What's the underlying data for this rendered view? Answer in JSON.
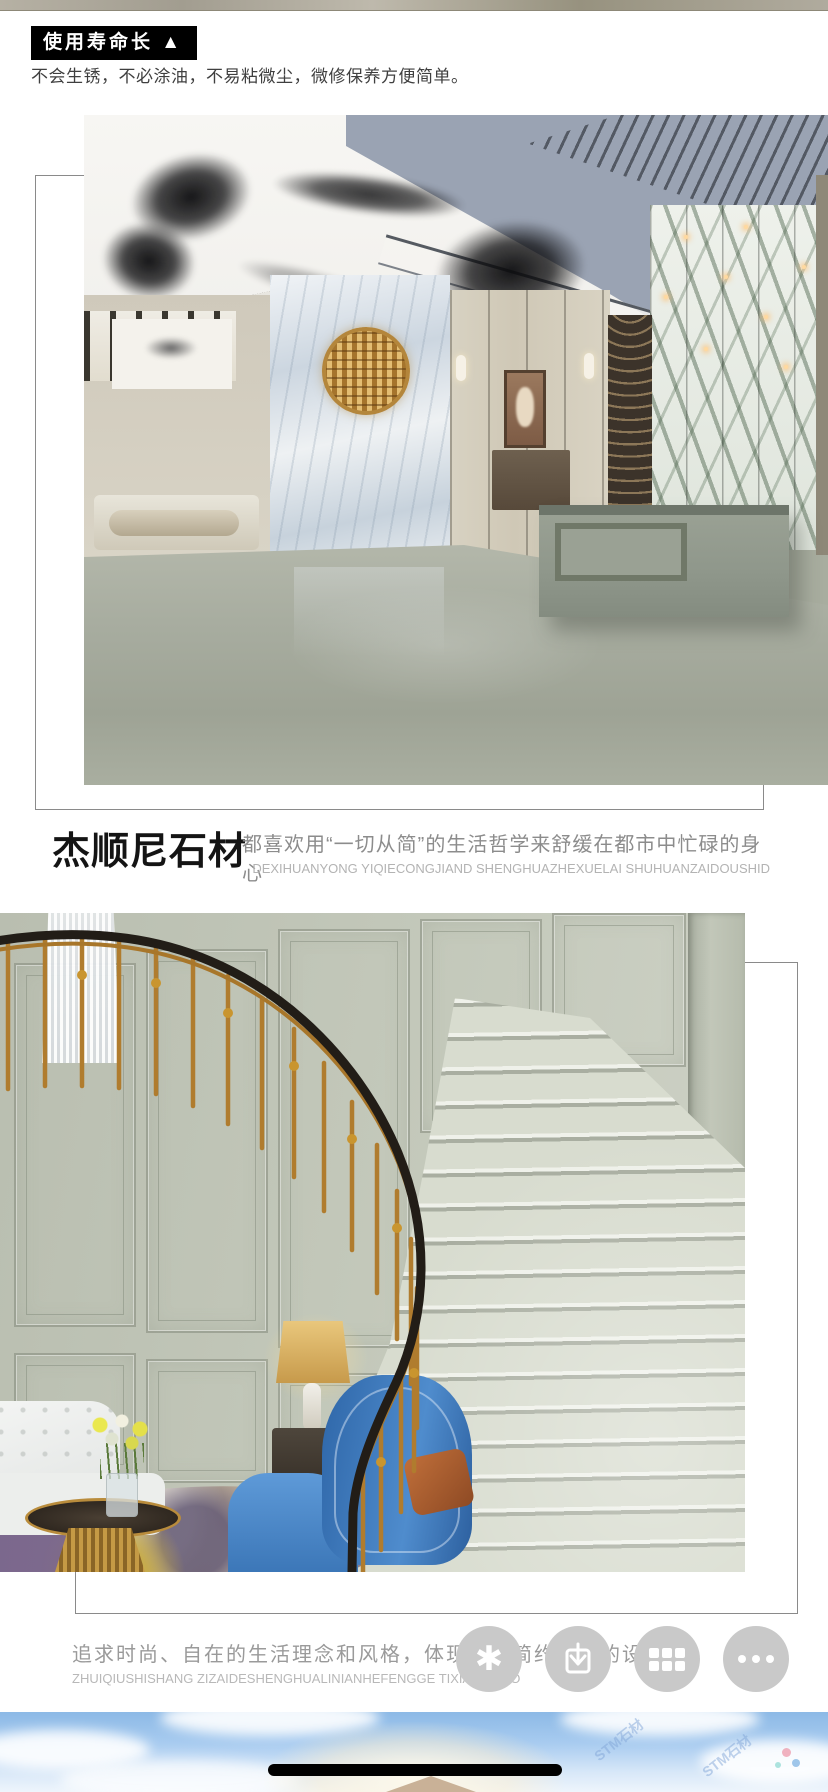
{
  "badge": {
    "label": "使用寿命长 ▲"
  },
  "intro": {
    "text": "不会生锈，不必涂油，不易粘微尘，微修保养方便简单。"
  },
  "brand": {
    "title": "杰顺尼石材",
    "description": "都喜欢用“一切从简”的生活哲学来舒缓在都市中忙碌的身心",
    "pinyin": "DEXIHUANYONG YIQIECONGJIAND SHENGHUAZHEXUELAI SHUHUANZAIDOUSHID"
  },
  "gallery": {
    "photo1_alt": "石材酒店大堂效果图：水墨吊顶、大理石背景墙、灰绿石材地面与接待台",
    "photo2_alt": "石材旋转楼梯效果图：金色栏杆、灰绿石材墙面与台阶、蓝色沙发"
  },
  "footer": {
    "description": "追求时尚、自在的生活理念和风格，体现一种简约大气的设计。",
    "pinyin": "ZHUIQIUSHISHANG ZIZAIDESHENGHUALINIANHEFENGGE TIXIANYIZHO"
  },
  "fab": {
    "asterisk_glyph": "✱",
    "icons": [
      "asterisk",
      "download",
      "apps-grid",
      "more"
    ]
  },
  "watermark": {
    "text": "STM石材"
  },
  "colors": {
    "badge_bg": "#000000",
    "text_dark": "#3f3f3f",
    "text_gray": "#8c8c8c",
    "text_light": "#b3b3b3",
    "fab_gray": "#c9c9c9",
    "stone_floor": "#a7ac9f",
    "sky_blue": "#8cb9e6"
  }
}
